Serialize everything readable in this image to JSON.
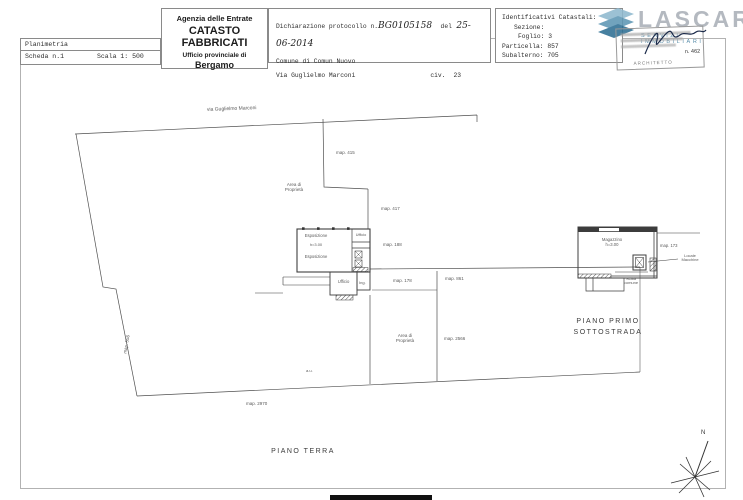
{
  "header": {
    "planimetria": {
      "title": "Planimetria",
      "scheda": "Scheda n.1",
      "scala": "Scala 1: 500"
    },
    "agenzia": {
      "line1": "Agenzia delle Entrate",
      "line2": "CATASTO FABBRICATI",
      "line3": "Ufficio provinciale di",
      "line4": "Bergamo"
    },
    "dichiarazione": {
      "label": "Dichiarazione protocollo n.",
      "protocollo": "BG0105158",
      "del": "del",
      "data": "25-06-2014",
      "comune": "Comune di Comun Nuovo",
      "via": "Via Guglielmo Marconi",
      "civ_label": "civ.",
      "civ_num": "23"
    },
    "catastali": {
      "title": "Identificativi Catastali:",
      "sezione": "Sezione:",
      "foglio": "Foglio: 3",
      "particella": "Particella: 857",
      "subalterno": "Subalterno: 705"
    }
  },
  "logo": {
    "name": "LASCARI",
    "subtitle": "SERVIZI IMMOBILIARI",
    "accent_color": "#2e6f94",
    "text_color": "#aab0b8"
  },
  "stamp": {
    "title": "ARCHITETTO",
    "number": "n. 462"
  },
  "plan": {
    "labels": {
      "street": "via Guglielmo Marconi",
      "map556": "map. 556",
      "map415": "map. 415",
      "map417": "map. 417",
      "map188": "map. 188",
      "map178": "map. 178",
      "map861": "map. 861",
      "map2566": "map. 2566",
      "map2970": "map. 2970",
      "map173": "map. 173",
      "misc": "a.u.",
      "area1_l1": "Area di",
      "area1_l2": "Proprietà",
      "area2_l1": "Area di",
      "area2_l2": "Proprietà",
      "esposizione1": "Esposizione",
      "altezza": "h=3.00",
      "esposizione2": "Esposizione",
      "ufficio1": "Ufficio",
      "ufficio2": "Ufficio",
      "ing": "Ing.",
      "magazzino": "Magazzino",
      "altezza_mag": "h=3.00",
      "locale_l1": "Locale",
      "locale_l2": "Macchine",
      "scala_l1": "Scala",
      "scala_l2": "comune"
    },
    "captions": {
      "terra": "PIANO TERRA",
      "primo_l1": "PIANO PRIMO",
      "primo_l2": "SOTTOSTRADA"
    },
    "compass": "N"
  }
}
